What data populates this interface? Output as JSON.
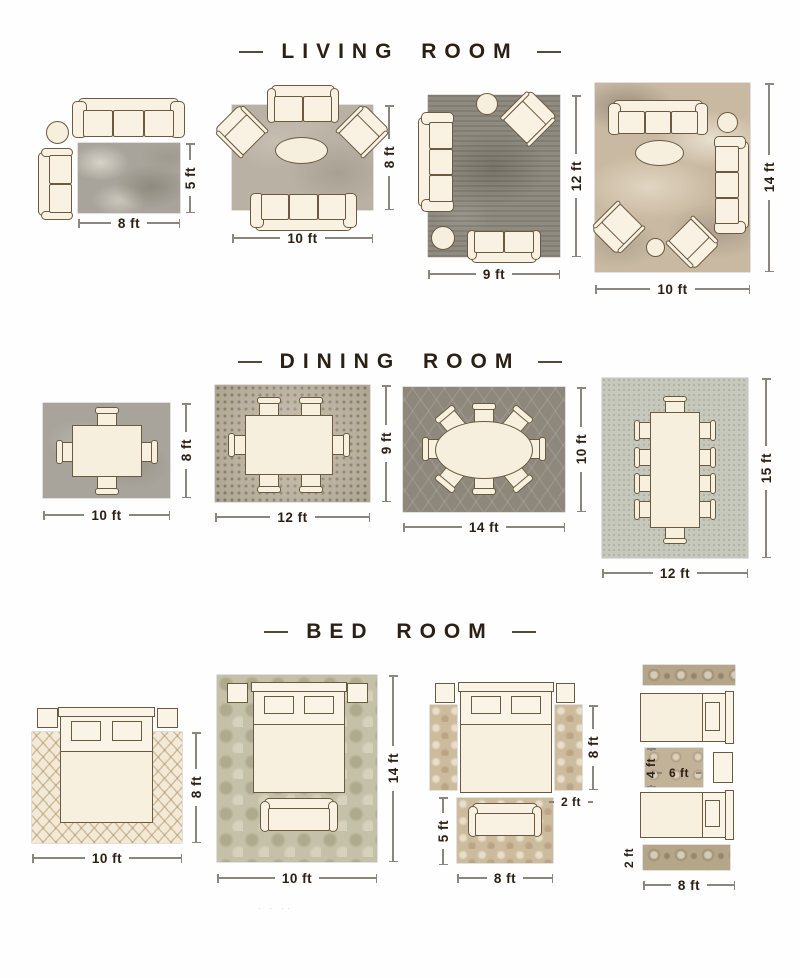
{
  "colors": {
    "accent_text": "#2b2014",
    "furniture_fill": "#f9f2e2",
    "furniture_line": "#6a5a40",
    "dimension_line": "#8a867e"
  },
  "sections": [
    {
      "id": "living-room",
      "title": "LIVING ROOM",
      "layouts": [
        {
          "width_label": "8 ft",
          "height_label": "5 ft"
        },
        {
          "width_label": "10 ft",
          "height_label": "8 ft"
        },
        {
          "width_label": "9 ft",
          "height_label": "12 ft"
        },
        {
          "width_label": "10 ft",
          "height_label": "14 ft"
        }
      ]
    },
    {
      "id": "dining-room",
      "title": "DINING ROOM",
      "layouts": [
        {
          "width_label": "10 ft",
          "height_label": "8 ft"
        },
        {
          "width_label": "12 ft",
          "height_label": "9 ft"
        },
        {
          "width_label": "14 ft",
          "height_label": "10 ft"
        },
        {
          "width_label": "12 ft",
          "height_label": "15 ft"
        }
      ]
    },
    {
      "id": "bed-room",
      "title": "BED ROOM",
      "layouts": [
        {
          "width_label": "10 ft",
          "height_label": "8 ft"
        },
        {
          "width_label": "10 ft",
          "height_label": "14 ft"
        },
        {
          "runner_height_label": "8 ft",
          "runner_width_label": "2 ft",
          "foot_rug_height_label": "5 ft",
          "foot_rug_width_label": "8 ft"
        },
        {
          "mid_rug_height_label": "4 ft",
          "mid_rug_width_label": "6 ft",
          "runner_height_label": "2 ft",
          "width_label": "8 ft"
        }
      ]
    }
  ],
  "footer": {
    "watermark": "· · ··"
  }
}
